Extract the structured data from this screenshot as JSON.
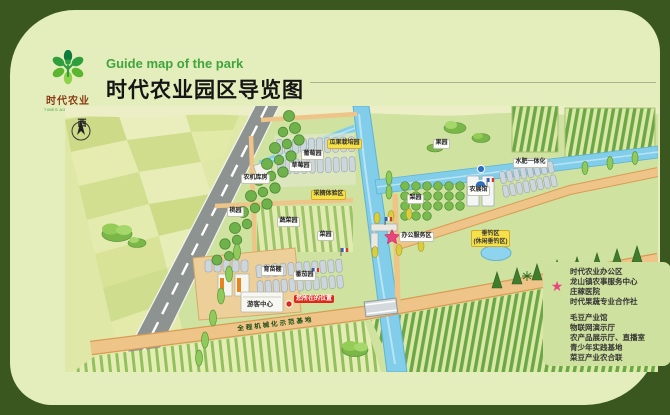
{
  "brand": {
    "name_cn": "时代农业",
    "name_en": "TIMES AGRICULTURE"
  },
  "header": {
    "subtitle_en": "Guide map of the park",
    "title_cn": "时代农业园区导览图"
  },
  "map": {
    "compass_label": "西",
    "you_are_here": "您所在的位置",
    "labels": [
      {
        "text": "瓜果栽培园"
      },
      {
        "text": "葡萄园"
      },
      {
        "text": "草莓园"
      },
      {
        "text": "农机库房"
      },
      {
        "text": "采摘体验区"
      },
      {
        "text": "桃园"
      },
      {
        "text": "蔬菜园"
      },
      {
        "text": "菜园"
      },
      {
        "text": "果园"
      },
      {
        "text": "梨园"
      },
      {
        "text": "农展馆"
      },
      {
        "text": "水肥一体化"
      },
      {
        "text": "办公服务区"
      },
      {
        "text": "垂钓区",
        "text2": "(休闲垂钓区)"
      },
      {
        "text": "育苗棚"
      },
      {
        "text": "番茄园"
      },
      {
        "text": "游客中心"
      },
      {
        "text": "您所在的位置"
      },
      {
        "text": "全程机械化示范基地"
      }
    ]
  },
  "legend": {
    "star_items": [
      "时代农业办公区",
      "龙山镇农事服务中心",
      "庄稼医院",
      "时代果蔬专业合作社"
    ],
    "dot_items": [
      "毛豆产业馆",
      "物联网演示厅",
      "农产品展示厅、直播室",
      "青少年实践基地",
      "菜豆产业农合联"
    ]
  },
  "colors": {
    "frame_green": "#3a571f",
    "card_bg": "#e4edbc",
    "accent_green": "#3fa53c",
    "brand_brown": "#8a3c16",
    "star_pink": "#e8457f",
    "marker_blue": "#2f6fc0",
    "locator_red": "#e0271c"
  }
}
